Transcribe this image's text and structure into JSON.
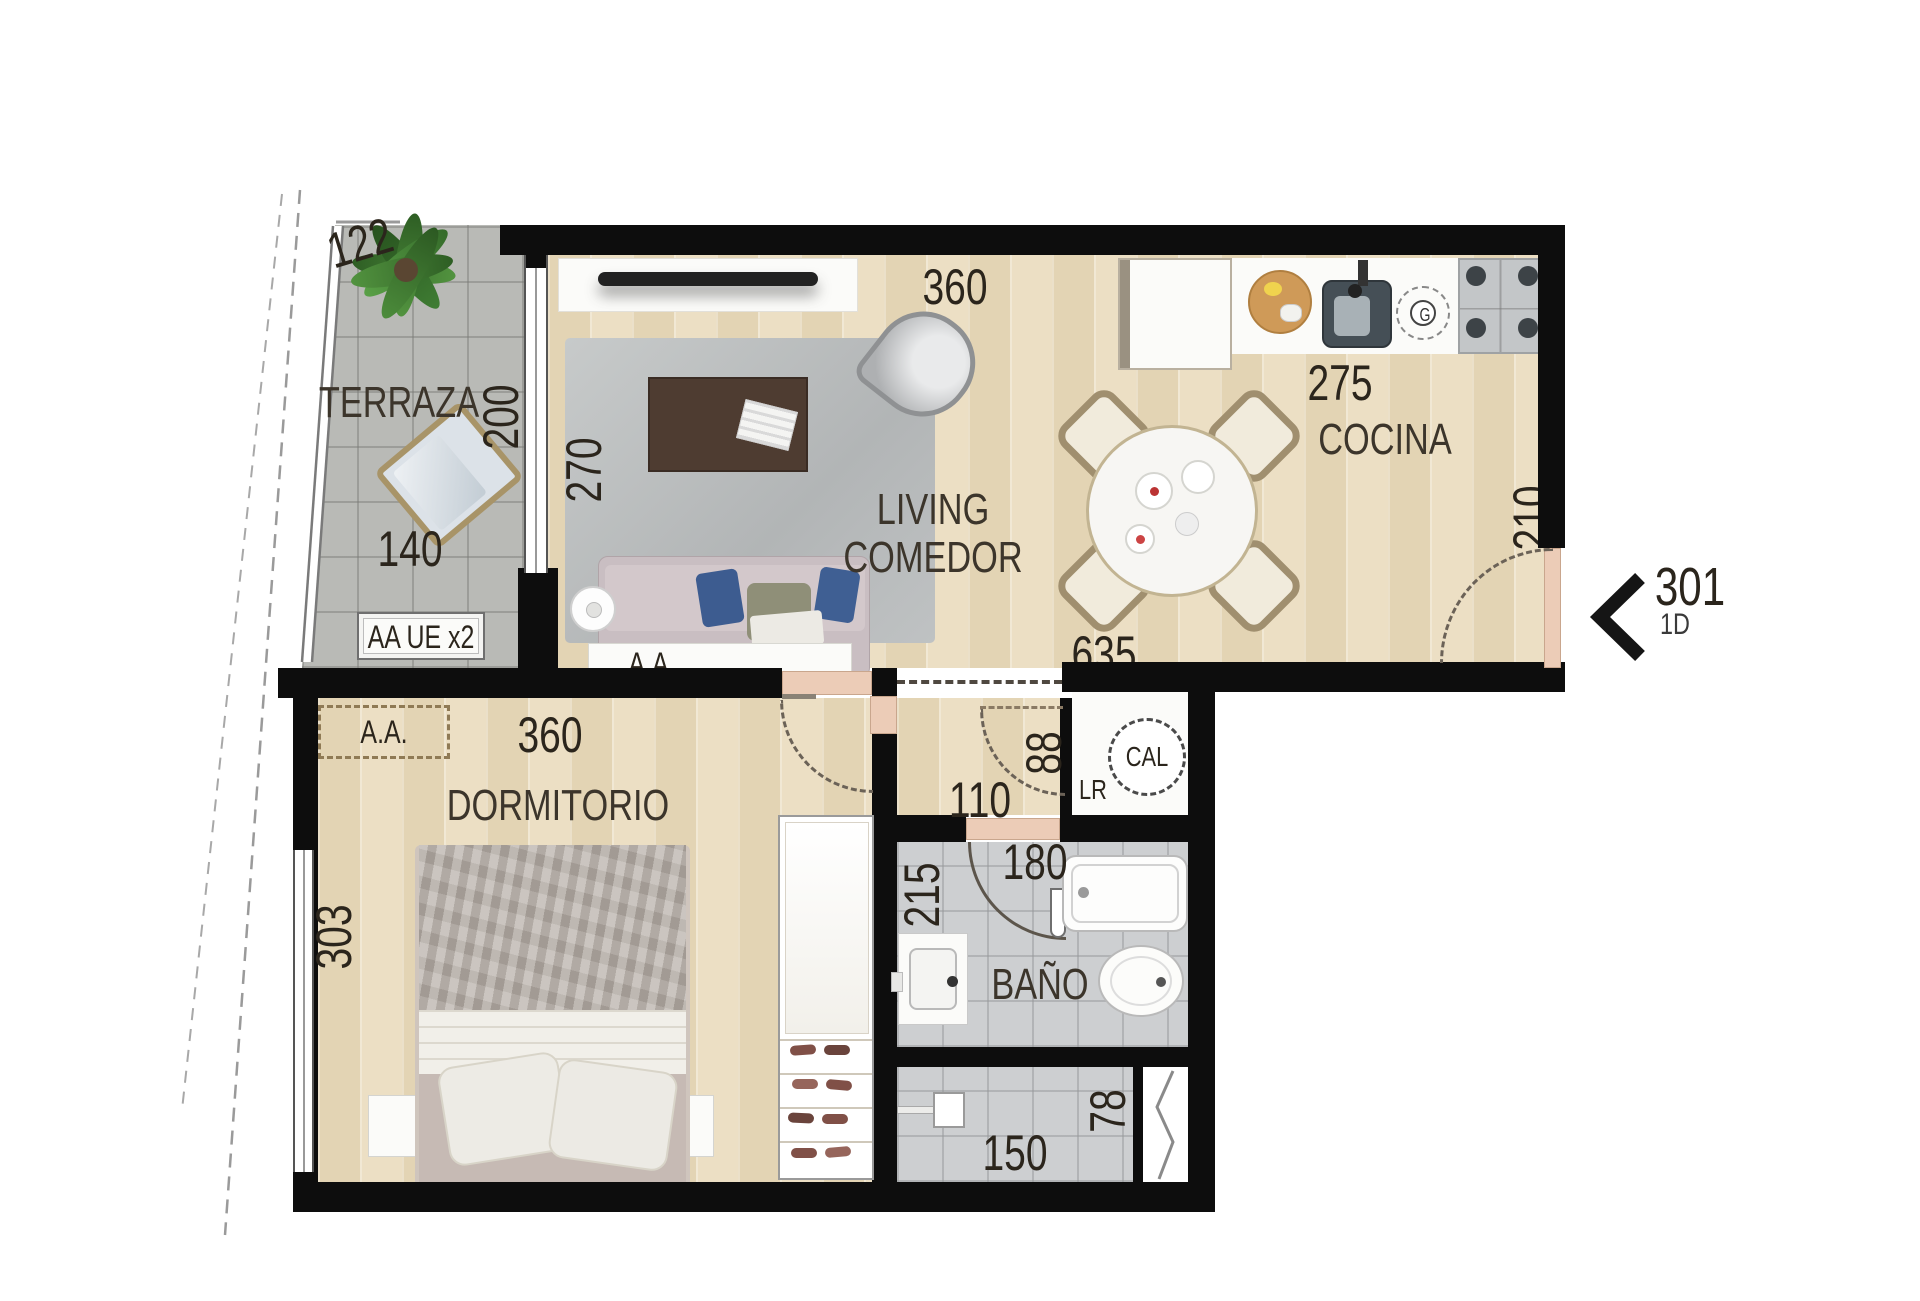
{
  "unit": {
    "number": "301",
    "type": "1D"
  },
  "terraza": {
    "name": "TERRAZA",
    "dim_front": "122",
    "dim_side": "200",
    "dim_width": "140",
    "equipment": "AA UE x2"
  },
  "living": {
    "name_line1": "LIVING",
    "name_line2": "COMEDOR",
    "dim_depth": "270",
    "dim_width": "360",
    "ac": "A.A."
  },
  "cocina": {
    "name": "COCINA",
    "dim_width": "275",
    "dim_door": "210",
    "dim_total": "635",
    "gas_mark": "G"
  },
  "hall": {
    "dim_width": "110",
    "dim_depth": "88"
  },
  "cal": {
    "heater": "CAL",
    "label": "LR"
  },
  "dormitorio": {
    "name": "DORMITORIO",
    "dim_width": "360",
    "dim_depth": "303",
    "ac": "A.A."
  },
  "bano": {
    "name": "BAÑO",
    "dim_width": "180",
    "dim_depth": "215"
  },
  "ducha": {
    "dim_width": "150",
    "dim_depth": "78"
  }
}
